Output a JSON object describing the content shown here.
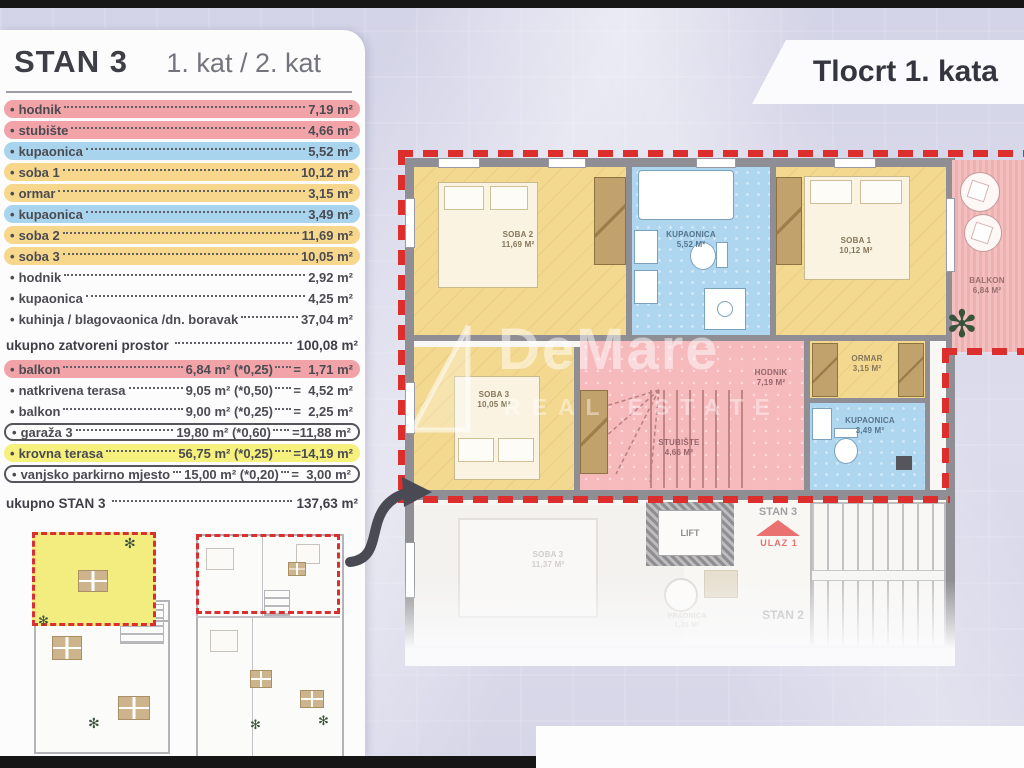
{
  "header": {
    "title": "STAN 3",
    "subtitle": "1. kat / 2. kat"
  },
  "plan_title": "Tlocrt 1. kata",
  "rooms": [
    {
      "label": "hodnik",
      "area": "7,19 m²",
      "color": "pink"
    },
    {
      "label": "stubište",
      "area": "4,66 m²",
      "color": "pink"
    },
    {
      "label": "kupaonica",
      "area": "5,52 m²",
      "color": "blue"
    },
    {
      "label": "soba 1",
      "area": "10,12 m²",
      "color": "yellow"
    },
    {
      "label": "ormar",
      "area": "3,15 m²",
      "color": "yellow"
    },
    {
      "label": "kupaonica",
      "area": "3,49 m²",
      "color": "blue"
    },
    {
      "label": "soba 2",
      "area": "11,69 m²",
      "color": "yellow"
    },
    {
      "label": "soba 3",
      "area": "10,05 m²",
      "color": "yellow"
    },
    {
      "label": "hodnik",
      "area": "2,92 m²",
      "color": "none"
    },
    {
      "label": "kupaonica",
      "area": "4,25 m²",
      "color": "none"
    },
    {
      "label": "kuhinja / blagovaonica /dn. boravak",
      "area": "37,04 m²",
      "color": "none"
    }
  ],
  "subtotal": {
    "label": "ukupno zatvoreni prostor",
    "area": "100,08 m²"
  },
  "extras": [
    {
      "label": "balkon",
      "area": "6,84 m²",
      "factor": "(*0,25)",
      "result": "=  1,71 m²",
      "color": "pink",
      "outlined": false
    },
    {
      "label": "natkrivena terasa",
      "area": "9,05 m²",
      "factor": "(*0,50)",
      "result": "=  4,52 m²",
      "color": "none",
      "outlined": false
    },
    {
      "label": "balkon",
      "area": "9,00 m²",
      "factor": "(*0,25)",
      "result": "=  2,25 m²",
      "color": "none",
      "outlined": false
    },
    {
      "label": "garaža 3",
      "area": "19,80 m²",
      "factor": "(*0,60)",
      "result": "=11,88 m²",
      "color": "none",
      "outlined": true
    },
    {
      "label": "krovna terasa",
      "area": "56,75 m²",
      "factor": "(*0,25)",
      "result": "=14,19 m²",
      "color": "yellowbright",
      "outlined": false
    },
    {
      "label": "vanjsko parkirno mjesto",
      "area": "15,00 m²",
      "factor": "(*0,20)",
      "result": "=  3,00 m²",
      "color": "none",
      "outlined": true
    }
  ],
  "total": {
    "label": "ukupno STAN 3",
    "area": "137,63 m²"
  },
  "thumbnails": {
    "left_caption": "Tlocrt krova",
    "right_caption": "Tlocrt 1. kata"
  },
  "plan": {
    "soba2": {
      "name": "SOBA 2",
      "area": "11,69 M²"
    },
    "kupaonica_top": {
      "name": "KUPAONICA",
      "area": "5,52 M²"
    },
    "soba1": {
      "name": "SOBA 1",
      "area": "10,12 M²"
    },
    "balkon": {
      "name": "BALKON",
      "area": "6,84 M²"
    },
    "soba3": {
      "name": "SOBA 3",
      "area": "10,05 M²"
    },
    "hodnik": {
      "name": "HODNIK",
      "area": "7,19 M²"
    },
    "ormar": {
      "name": "ORMAR",
      "area": "3,15 M²"
    },
    "stubiste": {
      "name": "STUBIŠTE",
      "area": "4,66 M²"
    },
    "kupaonica_small": {
      "name": "KUPAONICA",
      "area": "3,49 M²"
    },
    "lower": {
      "soba": {
        "name": "SOBA 3",
        "area": "11,37 M²"
      },
      "lift": "LIFT",
      "praonica": {
        "name": "PRAONICA",
        "area": "1,35 M²"
      },
      "stan3": "STAN 3",
      "ulaz": "ULAZ 1",
      "stan2": "STAN 2"
    }
  },
  "watermark": {
    "name": "DeMare",
    "tagline": "REAL ESTATE"
  },
  "colors": {
    "accent_red": "#dd2e2e",
    "pill_pink": "#f2a3a8",
    "pill_blue": "#a9d4ee",
    "pill_yellow": "#f6d78c",
    "highlight_yellow": "#f6f07d",
    "entrance_red": "#e02020"
  }
}
